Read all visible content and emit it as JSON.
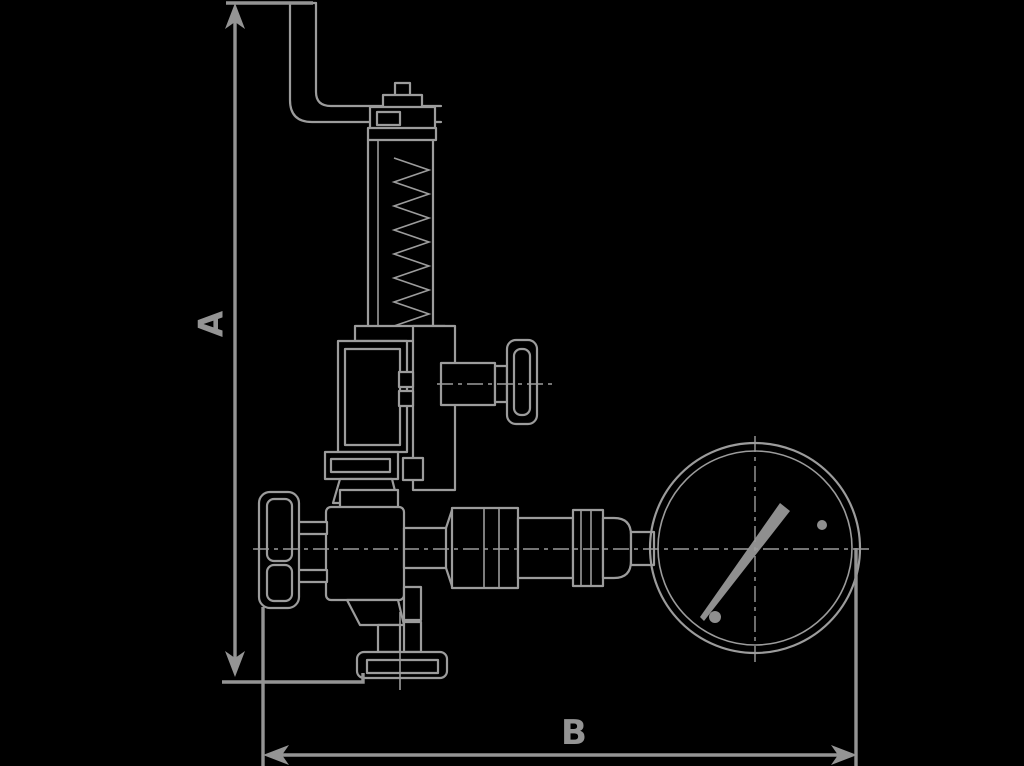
{
  "canvas": {
    "width": 1024,
    "height": 766,
    "background": "#000000"
  },
  "drawing": {
    "subject": "safety-valve-assembly-with-pressure-gauge-side-elevation",
    "colors": {
      "line": "#9c9c9c",
      "dimension": "#949494",
      "background": "#000000"
    },
    "dimensions": {
      "height": {
        "label": "A",
        "orientation": "vertical"
      },
      "width": {
        "label": "B",
        "orientation": "horizontal"
      }
    },
    "components": [
      "lifting-lever",
      "bonnet-cap",
      "spring-bonnet",
      "spring",
      "upper-body",
      "side-port",
      "side-knob",
      "mounting-flange",
      "handwheel",
      "valve-body",
      "union-fitting",
      "connecting-pipe",
      "reducer",
      "pressure-gauge",
      "gauge-needle",
      "bottom-outlet-flange"
    ],
    "gauge": {
      "needle_direction": "upper-right",
      "screw_dots": 2
    }
  }
}
